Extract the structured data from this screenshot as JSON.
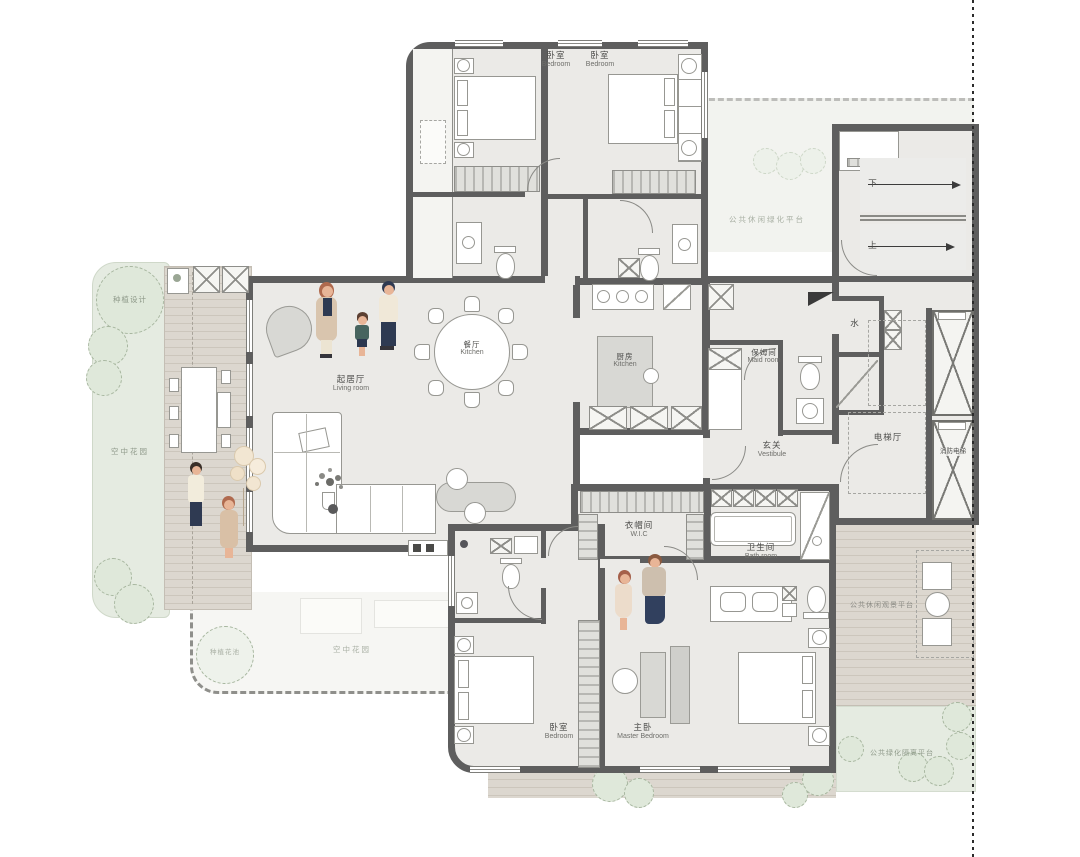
{
  "rooms": {
    "bedroom1": {
      "cn": "卧室",
      "en": "Bedroom"
    },
    "bedroom2": {
      "cn": "卧室",
      "en": "Bedroom"
    },
    "living": {
      "cn": "起居厅",
      "en": "Living room"
    },
    "dining": {
      "cn": "餐厅",
      "en": "Kitchen"
    },
    "kitchen": {
      "cn": "厨房",
      "en": "Kitchen"
    },
    "maid": {
      "cn": "保姆间",
      "en": "Maid room"
    },
    "vestibule": {
      "cn": "玄关",
      "en": "Vestibule"
    },
    "elevator_hall": {
      "cn": "电梯厅"
    },
    "water": {
      "cn": "水"
    },
    "fire_elevator": {
      "cn": "消防电梯"
    },
    "wic": {
      "cn": "衣帽间",
      "en": "W.I.C"
    },
    "bath": {
      "cn": "卫生间",
      "en": "Bath room"
    },
    "bedroom3": {
      "cn": "卧室",
      "en": "Bedroom"
    },
    "master": {
      "cn": "主卧",
      "en": "Master Bedroom"
    }
  },
  "stairs": {
    "down": "下",
    "up": "上"
  },
  "outdoor": {
    "planting_top": "种植设计",
    "garden_left": "空中花园",
    "planting_bottom": "种植花池",
    "garden_bottom": "空中花园",
    "green_top_right": "公共休闲绿化平台",
    "deck_right": "公共休闲观景平台",
    "green_bottom_right": "公共绿化隔离平台"
  },
  "colors": {
    "wall": "#5e5e5e",
    "floor": "#ebeae7",
    "deck": "#dcd7cf",
    "green": "#e5ebe1",
    "accent_skin": "#e8b597",
    "accent_navy": "#2e3a52",
    "accent_tan": "#d9c5ae"
  }
}
